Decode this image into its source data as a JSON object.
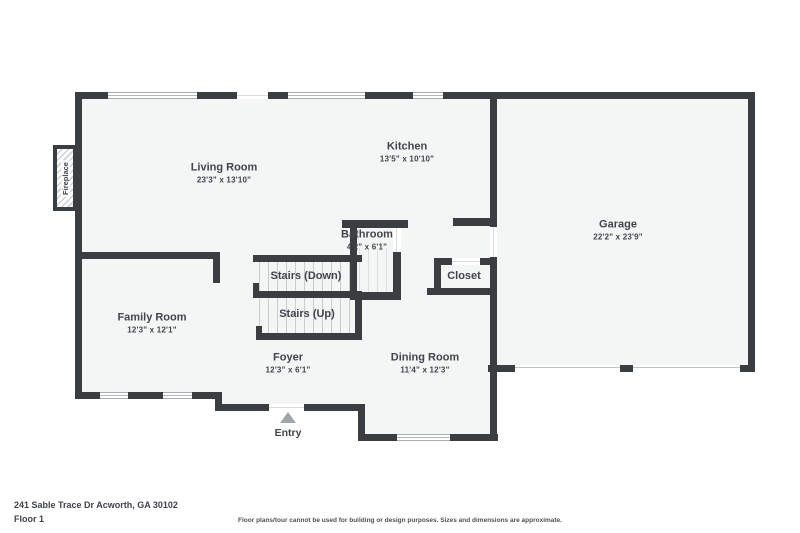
{
  "meta": {
    "address": "241 Sable Trace Dr Acworth, GA 30102",
    "floor": "Floor 1",
    "disclaimer": "Floor plans/tour cannot be used for building or design purposes. Sizes and dimensions are approximate."
  },
  "rooms": {
    "living": {
      "name": "Living Room",
      "dims": "23'3\" x 13'10\""
    },
    "kitchen": {
      "name": "Kitchen",
      "dims": "13'5\" x 10'10\""
    },
    "garage": {
      "name": "Garage",
      "dims": "22'2\" x 23'9\""
    },
    "bathroom": {
      "name": "Bathroom",
      "dims": "4'2\" x 6'1\""
    },
    "family": {
      "name": "Family Room",
      "dims": "12'3\" x 12'1\""
    },
    "foyer": {
      "name": "Foyer",
      "dims": "12'3\" x 6'1\""
    },
    "dining": {
      "name": "Dining Room",
      "dims": "11'4\" x 12'3\""
    },
    "closet": {
      "name": "Closet"
    },
    "stairs_down": {
      "name": "Stairs (Down)"
    },
    "stairs_up": {
      "name": "Stairs (Up)"
    }
  },
  "annotations": {
    "fireplace": "Fireplace",
    "entry": "Entry"
  },
  "colors": {
    "wall": "#3a3e41",
    "room_fill": "#f4f5f5",
    "label": "#40454b",
    "tread": "#c9cccd",
    "entry_arrow": "#a0a5a9"
  }
}
